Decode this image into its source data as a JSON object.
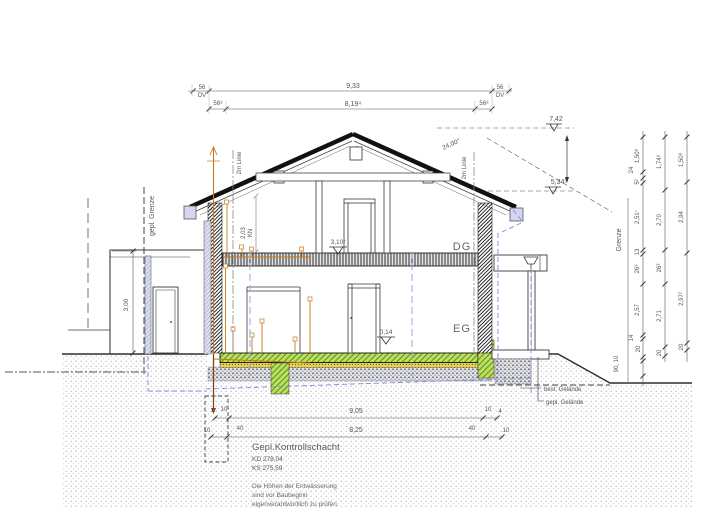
{
  "drawing": {
    "top_dims": {
      "row1": {
        "left_a": "56",
        "left_b": "DV",
        "span": "9,33",
        "right_a": "56",
        "right_b": "DV"
      },
      "row2": {
        "left": "56⁸",
        "span": "8,19⁴",
        "right": "56⁸"
      }
    },
    "levels": {
      "ridge": "7,42",
      "eave": "5,34⁵",
      "dg_floor": "3,10²",
      "eg_floor": "0,14"
    },
    "roof": {
      "angle": "24,00°"
    },
    "rooms": {
      "attic": "DG",
      "ground": "EG"
    },
    "ref_lines": {
      "two_m_left": "2m Linie",
      "two_m_right": "2m Linie",
      "knee_value": "2,03",
      "knee_label": "KN"
    },
    "boundaries": {
      "planned": "gepl. Grenze",
      "existing": "Grenze"
    },
    "garage": {
      "height": "3,00"
    },
    "terrain": {
      "existing": "best. Gelände",
      "planned": "gepl. Gelände"
    },
    "shaft": {
      "title": "Gepl.Kontrollschacht",
      "kd": "KD 278,04",
      "ks": "KS 275,59"
    },
    "note": {
      "l1": "Die Höhen der Entwässerung",
      "l2": "sind vor Baubeginn",
      "l3": "eigenverantwortlich zu prüfen."
    },
    "bottom_dims": {
      "row1": {
        "a": "4",
        "b": "10",
        "span": "9,05",
        "c": "10",
        "d": "4"
      },
      "row2": {
        "a": "10",
        "b": "40",
        "span": "8,25",
        "c": "40",
        "d": "10"
      }
    },
    "chains": {
      "c1": [
        "1,50⁸",
        "24",
        "5³",
        "2,51⁷",
        "13",
        "26³",
        "2,57",
        "14",
        "20",
        "90, 10"
      ],
      "c2": [
        "1,74⁸",
        "2,70",
        "26³",
        "2,71",
        "20"
      ],
      "c3": [
        "1,50⁸",
        "2,94",
        "2,97²",
        "20"
      ]
    },
    "colors": {
      "pipe_orange": "#c87820",
      "rain_blue": "#8486d8",
      "slab_green": "#7ab526",
      "gutter_lavender": "#d4d6ec"
    }
  }
}
